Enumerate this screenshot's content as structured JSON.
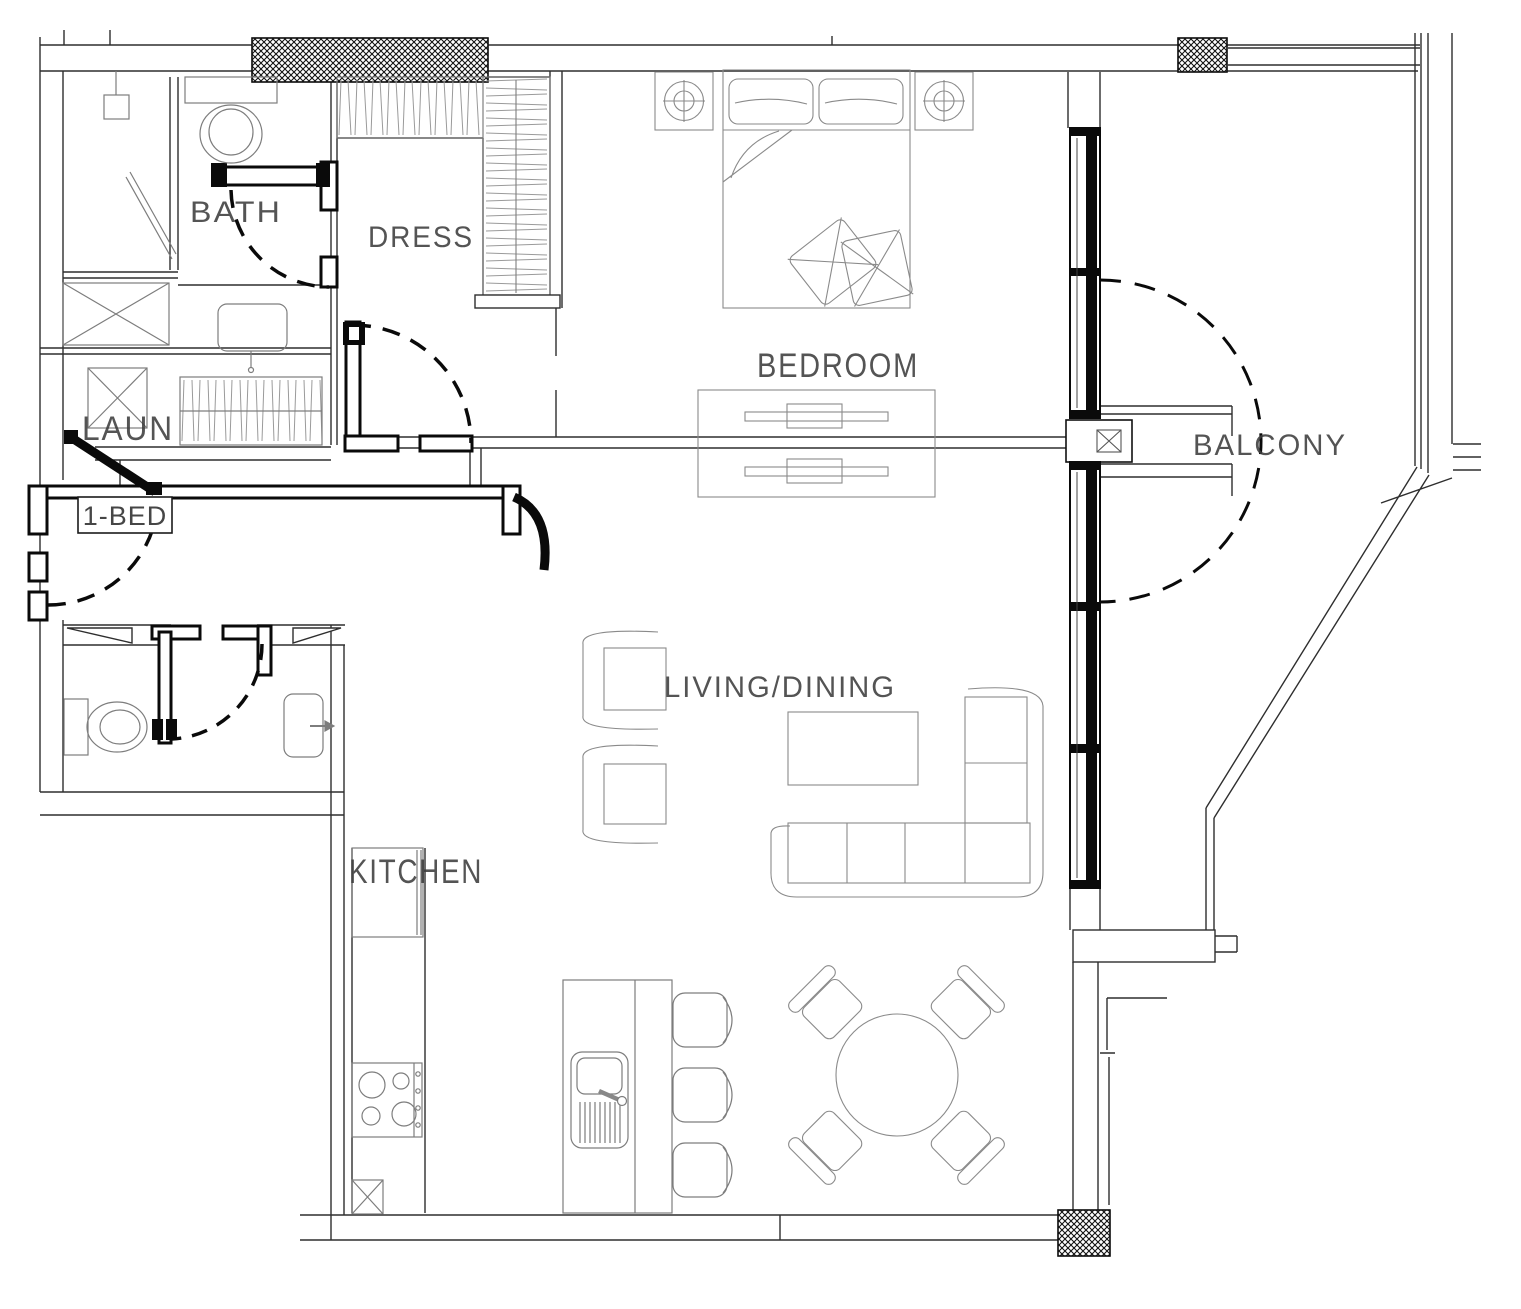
{
  "page": {
    "background": "#ffffff",
    "drawing_type": "apartment floor plan"
  },
  "unit": {
    "type_label": "1-BED"
  },
  "labels": {
    "bath": "BATH",
    "dress": "DRESS",
    "laundry": "LAUN",
    "unit": "1-BED",
    "bedroom": "BEDROOM",
    "balcony": "BALCONY",
    "living_dining": "LIVING/DINING",
    "kitchen": "KITCHEN"
  },
  "rooms": [
    {
      "name": "bath",
      "label": "BATH",
      "fixtures": [
        "shower",
        "shower-head",
        "glass-door",
        "toilet",
        "vanity-sink"
      ]
    },
    {
      "name": "dress",
      "label": "DRESS",
      "fixtures": [
        "hanging-wardrobe-top",
        "hanging-wardrobe-side"
      ]
    },
    {
      "name": "laundry",
      "label": "LAUN",
      "fixtures": [
        "washer-box",
        "dryer-box",
        "hanging-closet"
      ]
    },
    {
      "name": "bedroom",
      "label": "BEDROOM",
      "fixtures": [
        "double-bed",
        "nightstand-left",
        "nightstand-right",
        "tv-console"
      ]
    },
    {
      "name": "balcony",
      "label": "BALCONY",
      "fixtures": [
        "sliding-glass-wall",
        "door-swing"
      ]
    },
    {
      "name": "living_dining",
      "label": "LIVING/DINING",
      "fixtures": [
        "armchair",
        "armchair",
        "coffee-table",
        "l-shaped-sofa",
        "round-dining-table",
        "dining-chairs-4"
      ]
    },
    {
      "name": "kitchen",
      "label": "KITCHEN",
      "fixtures": [
        "fridge",
        "cooktop-4-burner",
        "island-with-sink",
        "bar-stools-3"
      ]
    },
    {
      "name": "powder_room",
      "fixtures": [
        "toilet",
        "sink"
      ]
    }
  ],
  "colors": {
    "wall_line": "#2e2e2e",
    "furniture_line": "#7d7d7d",
    "door_line": "#0a0a0a",
    "label_text": "#3d3d3d",
    "column_hatch": "#111111"
  }
}
